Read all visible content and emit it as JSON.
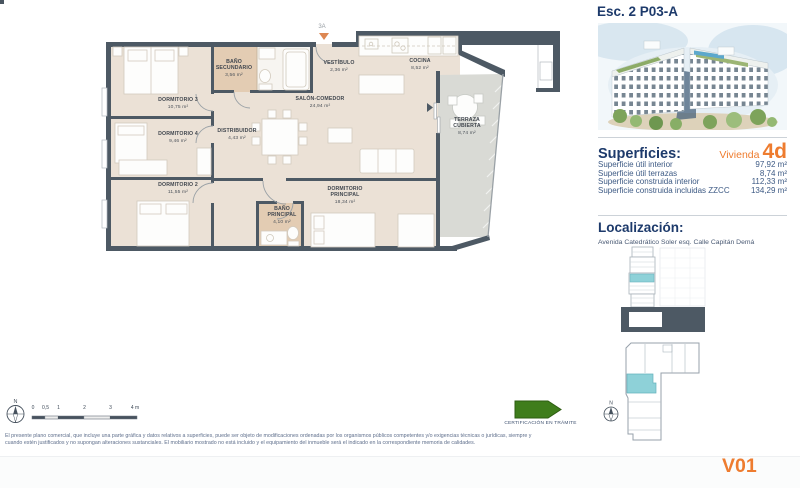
{
  "header": {
    "title": "Esc. 2 P03-A"
  },
  "superficies": {
    "heading": "Superficies:",
    "unit_label": "Vivienda",
    "unit_value": "4d",
    "rows": [
      {
        "label": "Superficie útil interior",
        "value": "97,92 m²"
      },
      {
        "label": "Superficie útil terrazas",
        "value": "8,74 m²"
      },
      {
        "label": "Superficie construida interior",
        "value": "112,33 m²"
      },
      {
        "label": "Superficie construida incluidas ZZCC",
        "value": "134,29 m²"
      }
    ]
  },
  "localizacion": {
    "heading": "Localización:",
    "address": "Avenida Catedrático Soler esq. Calle Capitán Demá"
  },
  "plan": {
    "entrance_label": "3A",
    "rooms": [
      {
        "name": "DORMITORIO 3",
        "name2": "",
        "area": "10,75 m²"
      },
      {
        "name": "DORMITORIO 4",
        "name2": "",
        "area": "9,46 m²"
      },
      {
        "name": "DORMITORIO 2",
        "name2": "",
        "area": "11,55 m²"
      },
      {
        "name": "BAÑO",
        "name2": "SECUNDARIO",
        "area": "3,56 m²"
      },
      {
        "name": "DISTRIBUIDOR",
        "name2": "",
        "area": "4,43 m²"
      },
      {
        "name": "VESTÍBULO",
        "name2": "",
        "area": "2,36 m²"
      },
      {
        "name": "COCINA",
        "name2": "",
        "area": "8,52 m²"
      },
      {
        "name": "SALÓN-COMEDOR",
        "name2": "",
        "area": "24,94 m²"
      },
      {
        "name": "TERRAZA",
        "name2": "CUBIERTA",
        "area": "8,74 m²"
      },
      {
        "name": "DORMITORIO",
        "name2": "PRINCIPAL",
        "area": "18,34 m²"
      },
      {
        "name": "BAÑO",
        "name2": "PRINCIPAL",
        "area": "4,10 m²"
      }
    ]
  },
  "footer": {
    "compass_label": "N",
    "scale_ticks": [
      "0",
      "0,5",
      "1",
      "2",
      "3",
      "4 m"
    ],
    "certification_label": "CERTIFICACIÓN EN TRÁMITE",
    "disclaimer_line1": "El presente plano comercial, que incluye una parte gráfica y datos relativos a superficies, puede ser objeto de modificaciones ordenadas por los organismos públicos competentes y/o exigencias técnicas o jurídicas, siempre y",
    "disclaimer_line2": "cuando estén justificados y no supongan alteraciones sustanciales. El mobiliario mostrado no está incluido y el equipamiento del inmueble será el indicado en la correspondiente memoria de calidades."
  },
  "version": "V01",
  "colors": {
    "heading_navy": "#1d3a6b",
    "accent_orange": "#ee7c2f",
    "wall_slate": "#4d5964",
    "floor_beige": "#ebe1d6",
    "bath_tan": "#e3ccb3",
    "terrace_gray": "#d9dad5",
    "highlight_teal": "#8ed1d8",
    "certification_green": "#3f7d1c"
  }
}
